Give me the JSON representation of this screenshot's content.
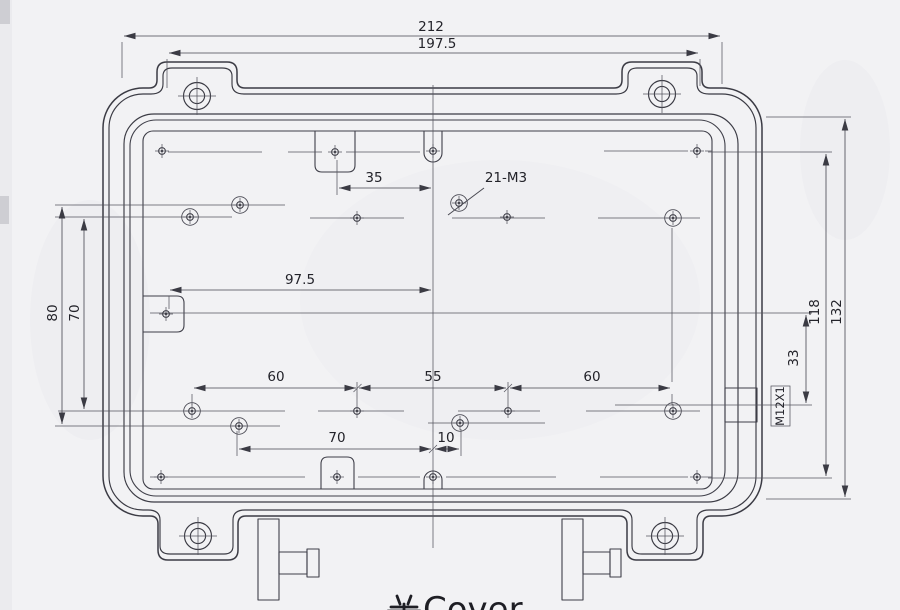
{
  "title": {
    "cn": "盖",
    "en": "Cover",
    "full": "盖Cover"
  },
  "dims": {
    "overall_width": "212",
    "flange_width": "197.5",
    "notch_to_center": "35",
    "holes_note": "21-M3",
    "boss_to_center": "97.5",
    "pitch_60_left": "60",
    "pitch_55": "55",
    "pitch_60_right": "60",
    "pitch_70": "70",
    "offset_10": "10",
    "left_height_80": "80",
    "left_height_70": "70",
    "right_height_118": "118",
    "right_height_132": "132",
    "gland_offset_33": "33",
    "gland_thread": "M12X1"
  },
  "colors": {
    "paper": "#f2f2f4",
    "outline": "#3b3b44",
    "thin_line": "#55555e",
    "text": "#23232a"
  }
}
